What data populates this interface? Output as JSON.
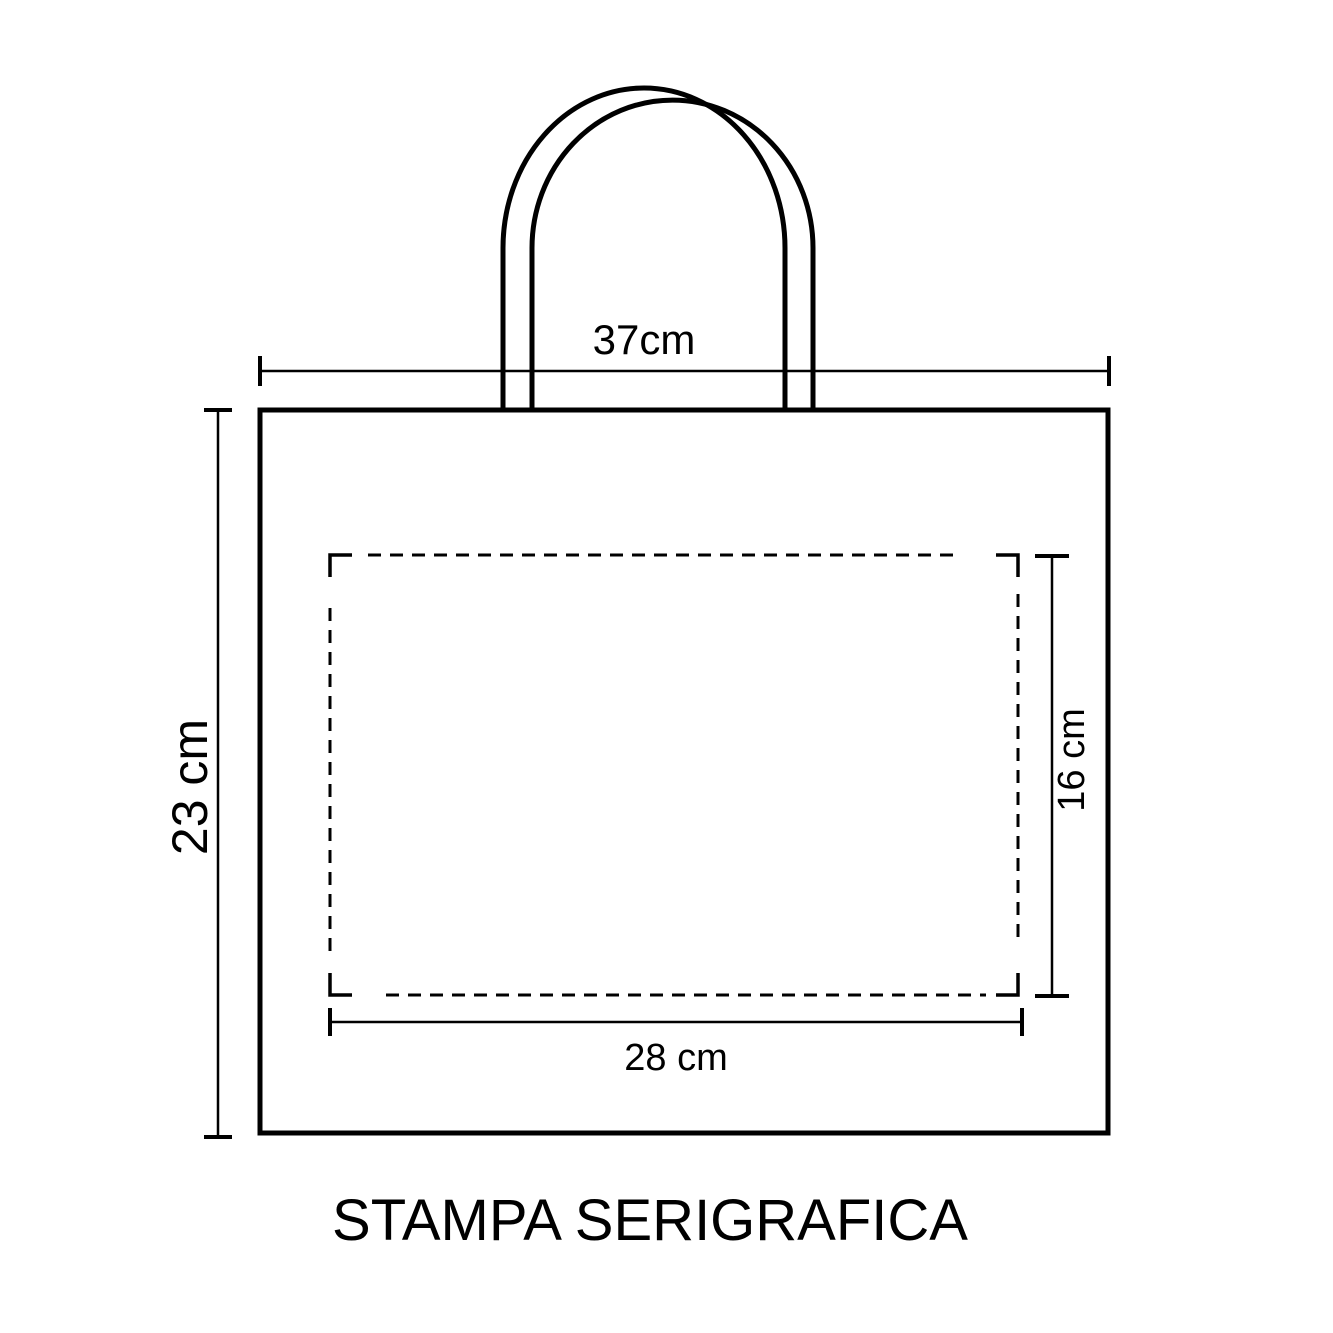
{
  "title": "STAMPA SERIGRAFICA",
  "dimensions": {
    "bag_width": "37cm",
    "bag_height": "23 cm",
    "print_area_width": "28 cm",
    "print_area_height": "16 cm"
  },
  "colors": {
    "ink": "#000000",
    "bg": "#ffffff"
  }
}
